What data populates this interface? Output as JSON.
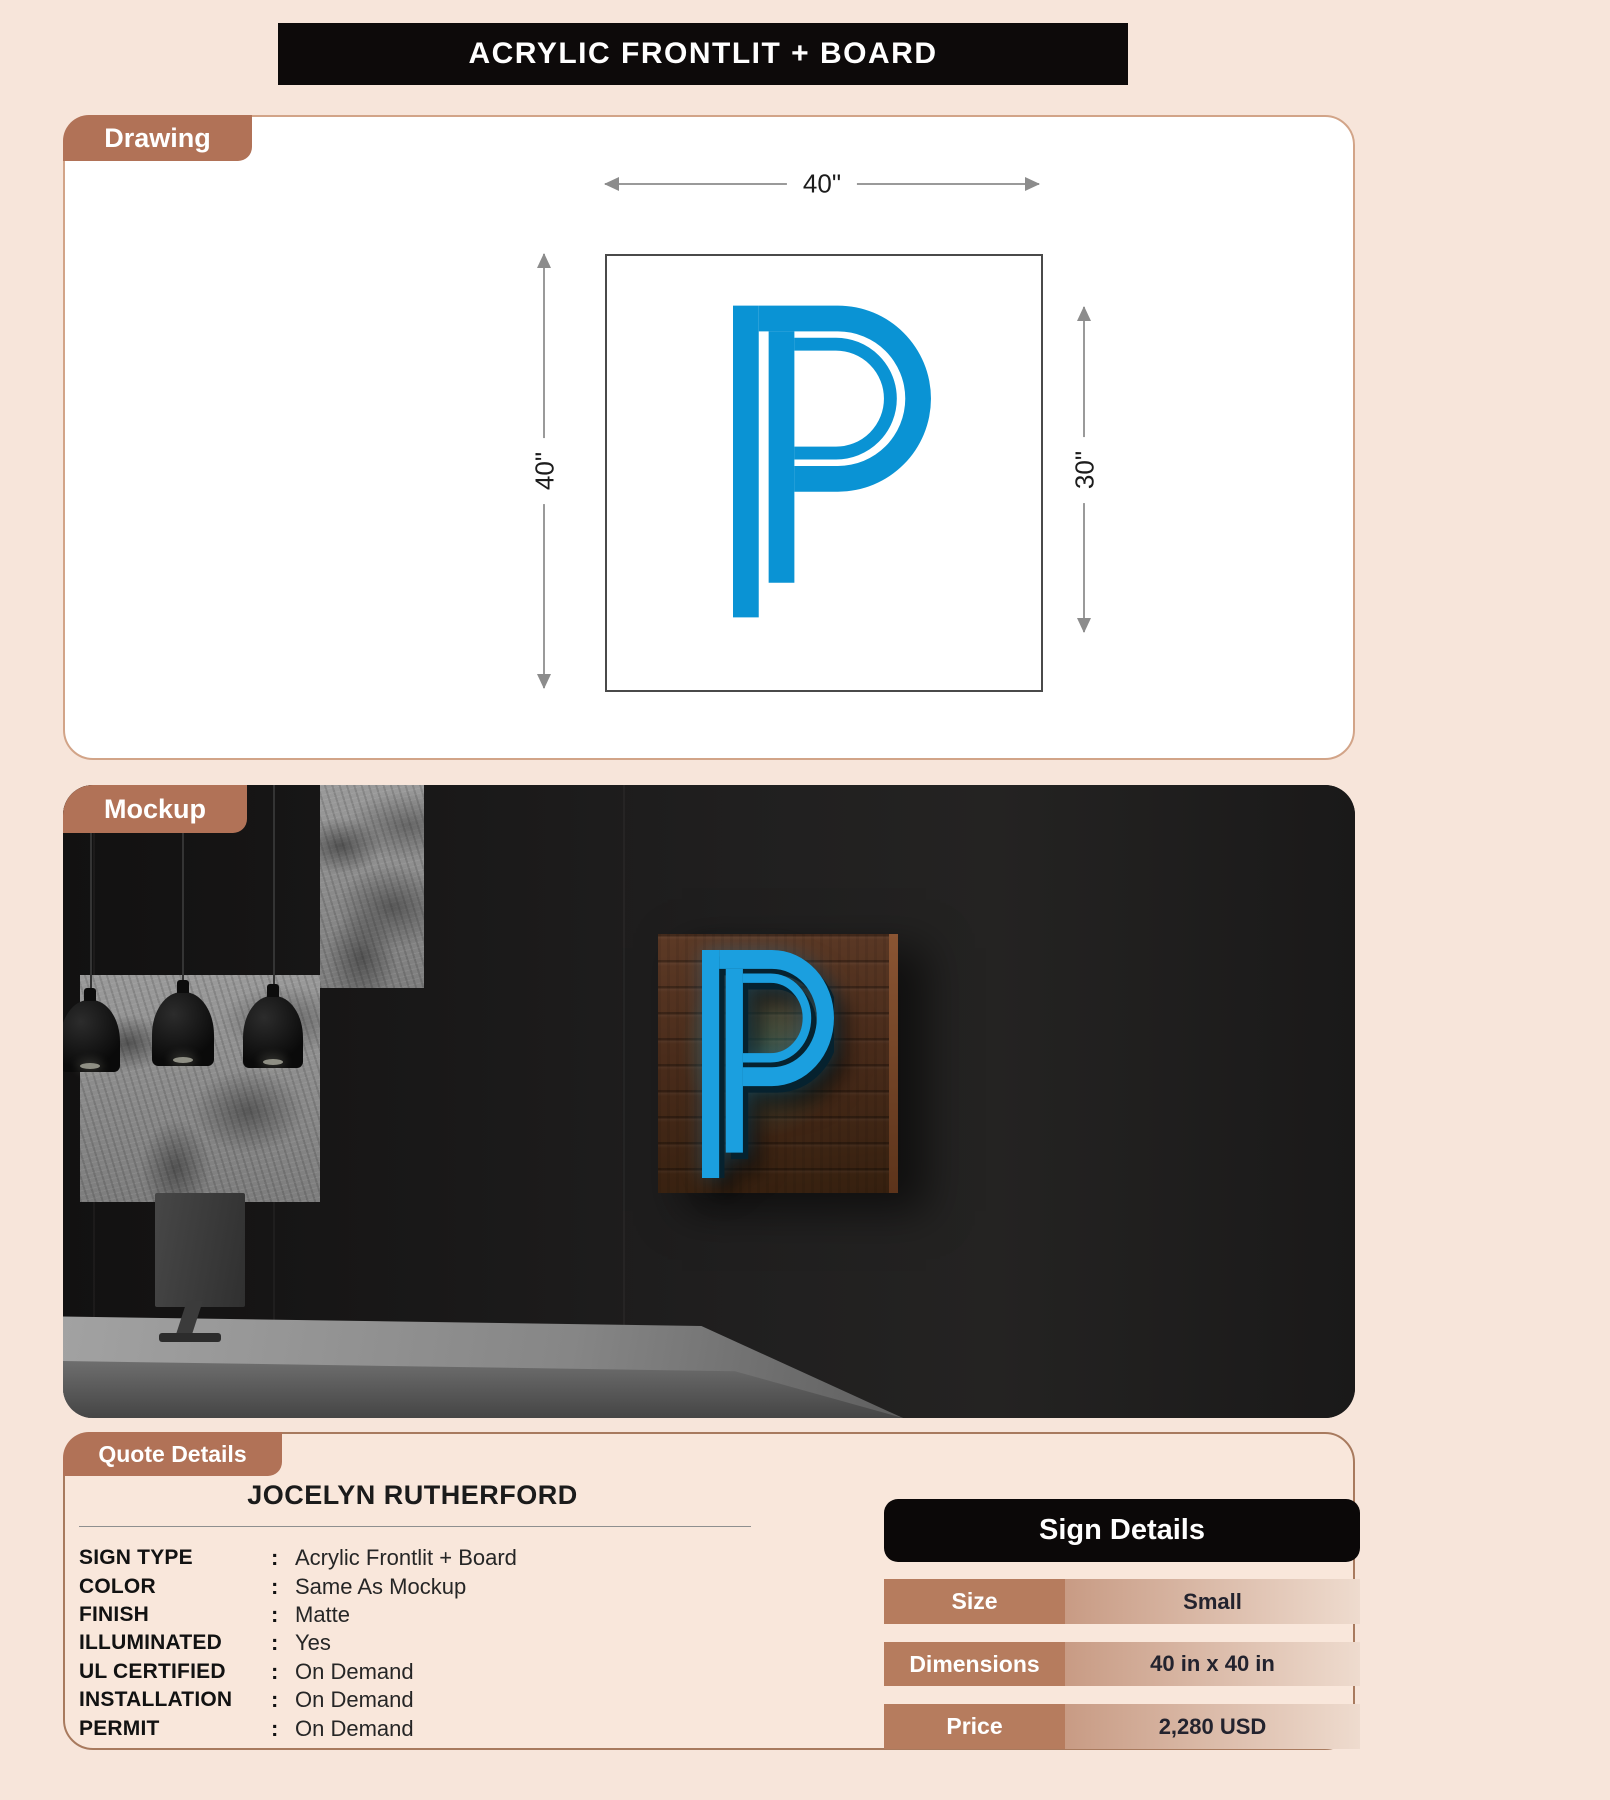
{
  "page": {
    "title": "ACRYLIC FRONTLIT + BOARD"
  },
  "drawing": {
    "tag": "Drawing",
    "letter": "P",
    "width_label": "40\"",
    "height_label": "40\"",
    "letter_height_label": "30\""
  },
  "mockup": {
    "tag": "Mockup",
    "sign_letter": "P"
  },
  "quote": {
    "tag": "Quote Details",
    "customer_name": "JOCELYN RUTHERFORD",
    "separator": ":",
    "specs": [
      {
        "label": "SIGN TYPE",
        "value": "Acrylic Frontlit + Board"
      },
      {
        "label": "COLOR",
        "value": "Same As Mockup"
      },
      {
        "label": "FINISH",
        "value": "Matte"
      },
      {
        "label": "ILLUMINATED",
        "value": "Yes"
      },
      {
        "label": "UL CERTIFIED",
        "value": "On Demand"
      },
      {
        "label": "INSTALLATION",
        "value": "On Demand"
      },
      {
        "label": "PERMIT",
        "value": "On Demand"
      }
    ],
    "sign_details": {
      "title": "Sign Details",
      "rows": [
        {
          "label": "Size",
          "value": "Small"
        },
        {
          "label": "Dimensions",
          "value": "40 in x 40 in"
        },
        {
          "label": "Price",
          "value": "2,280 USD"
        }
      ]
    }
  },
  "colors": {
    "page_background": "#f7e5da",
    "accent_brown": "#b17257",
    "sign_blue": "#0a93d4",
    "header_black": "#0d0a0a",
    "table_label_brown": "#b67c5e"
  }
}
